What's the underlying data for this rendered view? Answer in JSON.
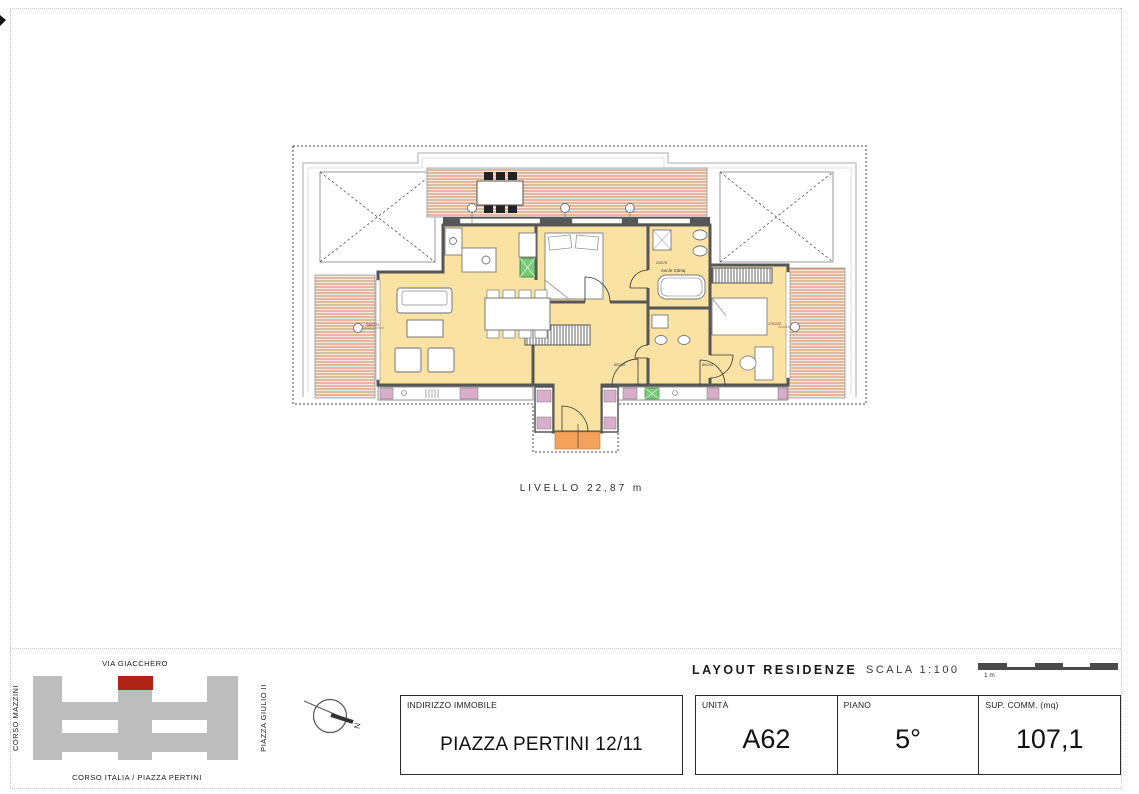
{
  "plan": {
    "level_label": "LIVELLO  22,87 m",
    "bath_label": "Avc.le 3,5mq",
    "dim_bath_door": "210/75",
    "dim_door_1": "80/210",
    "dim_door_2": "80/210",
    "dim_window_left": "240/270",
    "dim_window_right": "170/225"
  },
  "location_map": {
    "street_top": "VIA GIACCHERO",
    "street_left": "CORSO MAZZINI",
    "street_right": "PIAZZA GIULIO II",
    "street_bottom": "CORSO ITALIA / PIAZZA PERTINI",
    "highlight_color": "#b02418",
    "building_color": "#bdbdbd"
  },
  "compass": {
    "north_label": "N"
  },
  "title_block": {
    "layout_title": "LAYOUT RESIDENZE",
    "scale_label": "SCALA 1:100",
    "scale_bar_label": "1 m",
    "address": {
      "label": "INDIRIZZO IMMOBILE",
      "value": "PIAZZA PERTINI 12/11"
    },
    "cells": [
      {
        "label": "UNITÀ",
        "value": "A62"
      },
      {
        "label": "PIANO",
        "value": "5°"
      },
      {
        "label": "SUP. COMM. (mq)",
        "value": "107,1"
      }
    ]
  },
  "colors": {
    "interior_yellow": "#FAE2A2",
    "terrace_stripe": "#C98A64",
    "wall_gray": "#565656",
    "entry_orange": "#F4A259",
    "closet_pink": "#D9AECA",
    "appliance_green": "#79C979",
    "map_gray": "#BDBDBD",
    "highlight_red": "#B02418"
  }
}
